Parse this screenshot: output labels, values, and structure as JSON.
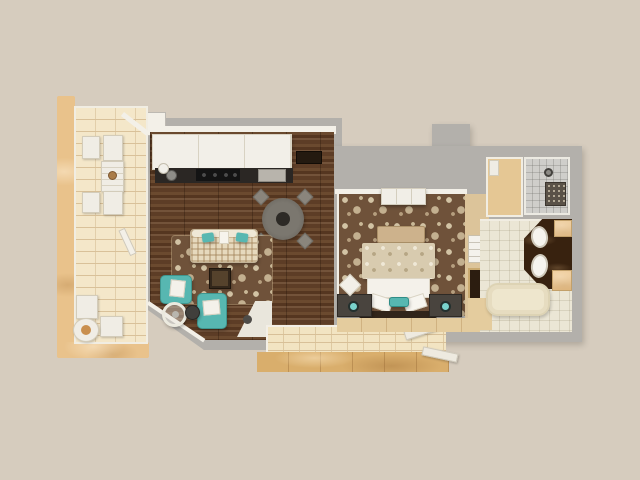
{
  "scene": {
    "title": "apartment-3d-floor-plan",
    "type": "3d-rendered top-down one-bedroom floor plan, no text labels",
    "background_color": "#d6ccbe"
  },
  "palette": {
    "background": "#d6ccbe",
    "wall_gray": "#b3b0ab",
    "wall_white": "#f3f0e8",
    "wood_floor": "#5d3d26",
    "carpet_brown": "#6f523a",
    "carpet_motif_cream": "#cfc0a1",
    "tile_cream": "#f4e7c9",
    "tile_gold": "#d9ae6c",
    "tan_marble": "#e9c28b",
    "teal_accent": "#57b7b1",
    "teal_lamp": "#79d3cd",
    "counter_dark": "#2b2724",
    "vanity_marble": "#38220f",
    "tub_cream": "#eee6cd",
    "bathroom_tile": "#ebe6d5",
    "shower_tile": "#cfceca",
    "bench_tan": "#cdb28c",
    "nightstand_dark": "#49443e"
  },
  "rooms": [
    {
      "id": "left-balcony",
      "name": "Left balcony patio",
      "floor": "cream brick tile with tan stone planter ledge",
      "items": [
        "white wicker armchair x4",
        "white slatted table with decorative bowl",
        "white bistro chair x2",
        "round table with flower centerpiece"
      ]
    },
    {
      "id": "living-kitchen",
      "name": "Living room with open kitchen",
      "floor": "dark walnut plank hardwood",
      "items": [
        "white upper cabinet run",
        "dark kitchen counter with cooktop and sink",
        "white kettle",
        "appliance mat",
        "dark wall console",
        "round dining table",
        "dining chair x4",
        "plaid sofa with 2 teal pillows and white throw",
        "brown damask area rug",
        "dark wood coffee table",
        "teal armchair x2 with white cushions",
        "round glass side table",
        "dark round side table",
        "white corner tile pad with dark disc"
      ]
    },
    {
      "id": "bedroom",
      "name": "Bedroom",
      "floor": "brown damask carpet",
      "items": [
        "white dresser",
        "tan upholstered bench",
        "double bed with paisley duvet",
        "white folded sheet",
        "white pillow x2",
        "teal accent pillow",
        "dark headboard",
        "dark nightstand x2",
        "teal table lamp x2",
        "white floor cushion",
        "wall niche with towels",
        "wall niche artwork"
      ]
    },
    {
      "id": "walk-in-closet",
      "name": "Walk-in closet",
      "floor": "tan marble",
      "items": [
        "white shelf unit"
      ]
    },
    {
      "id": "shower-room",
      "name": "Walk-in shower",
      "floor": "gray tile",
      "items": [
        "rain shower head",
        "dark mosaic floor mat"
      ]
    },
    {
      "id": "bathroom",
      "name": "Bathroom",
      "floor": "light stone tile with tan entry pad",
      "items": [
        "angled dark marble double vanity",
        "white vessel sink x2",
        "tan counter end x2",
        "cream soaking bathtub"
      ]
    },
    {
      "id": "hallway",
      "name": "Hallway along bedroom",
      "floor": "tan tile",
      "items": []
    },
    {
      "id": "rear-balcony",
      "name": "Rear balcony",
      "floor": "gold marble tile with cream brick parapet",
      "items": [
        "white door leaf x2"
      ]
    }
  ]
}
